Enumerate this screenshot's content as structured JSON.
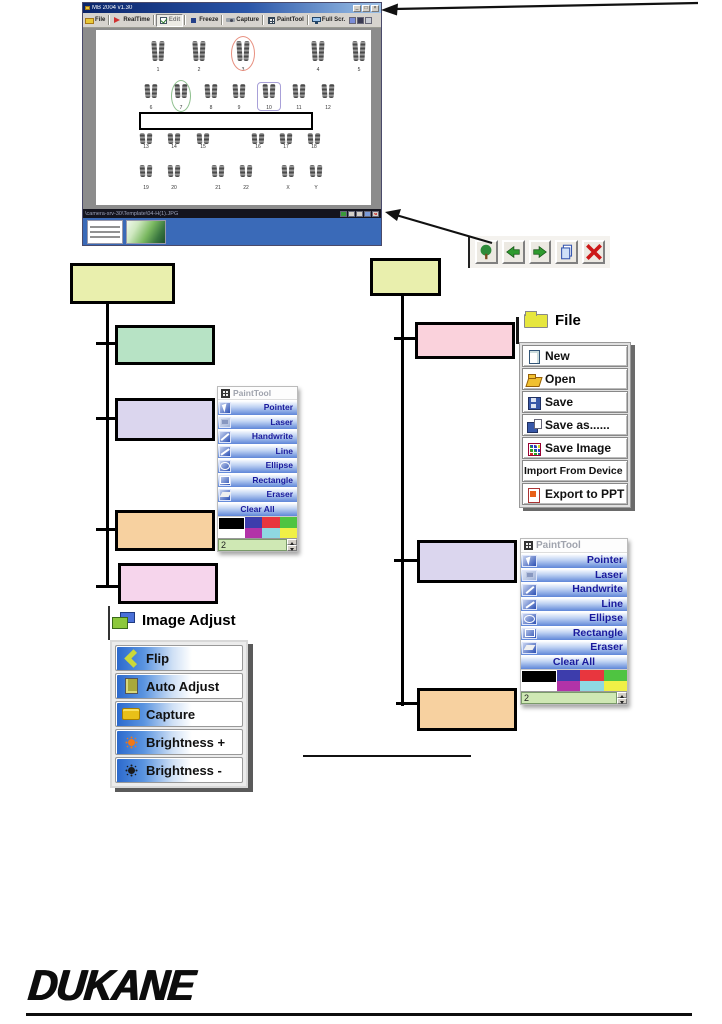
{
  "window": {
    "title": "MB 2004 v1.30",
    "controls": [
      "minimize",
      "maximize",
      "close"
    ],
    "toolbar": {
      "items": [
        {
          "label": "File",
          "icon": "folder"
        },
        {
          "label": "RealTime",
          "icon": "realtime"
        },
        {
          "label": "Edit",
          "icon": "edit",
          "state": "pressed"
        },
        {
          "label": "Freeze",
          "icon": "freeze"
        },
        {
          "label": "Capture",
          "icon": "camera"
        },
        {
          "label": "PaintTool",
          "icon": "grid"
        },
        {
          "label": "Full Scr.",
          "icon": "monitor"
        }
      ],
      "extra_icons": [
        "display-icon",
        "settings-icon",
        "panel-icon"
      ]
    },
    "karyotype": {
      "rows": [
        [
          "1",
          "2",
          "3",
          "4",
          "5"
        ],
        [
          "6",
          "7",
          "8",
          "9",
          "10",
          "11",
          "12"
        ],
        [
          "13",
          "14",
          "15",
          "16",
          "17",
          "18"
        ],
        [
          "19",
          "20",
          "21",
          "22",
          "X",
          "Y"
        ]
      ],
      "annotations": [
        {
          "target": "3",
          "shape": "red-ellipse",
          "color": "#e89080"
        },
        {
          "target": "7",
          "shape": "green-ellipse",
          "color": "#8ec08e"
        },
        {
          "target": "10",
          "shape": "purple-rect",
          "color": "#a8a0d8"
        },
        {
          "target": "6-11",
          "shape": "black-rect",
          "color": "#000000"
        }
      ]
    },
    "status_bar": {
      "path": "\\camera-srv-30\\Template\\04-H(1).JPG",
      "buttons": [
        "insert-image",
        "previous",
        "next",
        "copy",
        "close"
      ]
    },
    "filmstrip": {
      "thumbnails": [
        "karyotype-thumbnail",
        "plant-thumbnail"
      ]
    }
  },
  "nav_strip": {
    "buttons": [
      {
        "icon": "image-insert"
      },
      {
        "icon": "arrow-left"
      },
      {
        "icon": "arrow-right"
      },
      {
        "icon": "copy"
      },
      {
        "icon": "delete-x"
      }
    ]
  },
  "flowchart": {
    "left": {
      "root": {
        "label": "",
        "color": "#e9efad"
      },
      "children": [
        {
          "label": "",
          "color": "#b7e3c5"
        },
        {
          "label": "",
          "color": "#dbd6ee"
        },
        {
          "label": "",
          "color": "#f7d1a0"
        },
        {
          "label": "",
          "color": "#f6d5ec"
        }
      ]
    },
    "right": {
      "root": {
        "label": "",
        "color": "#e9efad"
      },
      "children": [
        {
          "label": "",
          "color": "#fad2dc"
        },
        {
          "label": "",
          "color": "#dbd6ee"
        },
        {
          "label": "",
          "color": "#f7d1a0"
        }
      ]
    }
  },
  "file_menu": {
    "title": "File",
    "items": [
      {
        "label": "New",
        "icon": "new-page"
      },
      {
        "label": "Open",
        "icon": "open-folder"
      },
      {
        "label": "Save",
        "icon": "floppy"
      },
      {
        "label": "Save as......",
        "icon": "floppy-page"
      },
      {
        "label": "Save Image",
        "icon": "color-grid"
      },
      {
        "label": "Import From Device",
        "icon": ""
      },
      {
        "label": "Export to PPT",
        "icon": "ppt-doc"
      }
    ]
  },
  "painttool": {
    "title": "PaintTool",
    "tools": [
      {
        "label": "Pointer",
        "icon": "pointer"
      },
      {
        "label": "Laser",
        "icon": "laser"
      },
      {
        "label": "Handwrite",
        "icon": "handwrite"
      },
      {
        "label": "Line",
        "icon": "line"
      },
      {
        "label": "Ellipse",
        "icon": "ellipse"
      },
      {
        "label": "Rectangle",
        "icon": "rectangle"
      },
      {
        "label": "Eraser",
        "icon": "eraser"
      },
      {
        "label": "Clear All",
        "icon": ""
      }
    ],
    "palette": [
      "#000000",
      "#3d3dac",
      "#e8363e",
      "#4fc441",
      "#b233a8",
      "#8fd8e2",
      "#f0f046"
    ],
    "line_width": "2"
  },
  "image_adjust": {
    "title": "Image Adjust",
    "items": [
      {
        "label": "Flip",
        "icon": "flip-chevron"
      },
      {
        "label": "Auto Adjust",
        "icon": "clipboard"
      },
      {
        "label": "Capture",
        "icon": "camera"
      },
      {
        "label": "Brightness +",
        "icon": "sun-bright"
      },
      {
        "label": "Brightness -",
        "icon": "sun-dim"
      }
    ]
  },
  "logo": {
    "text": "DUKANE"
  }
}
